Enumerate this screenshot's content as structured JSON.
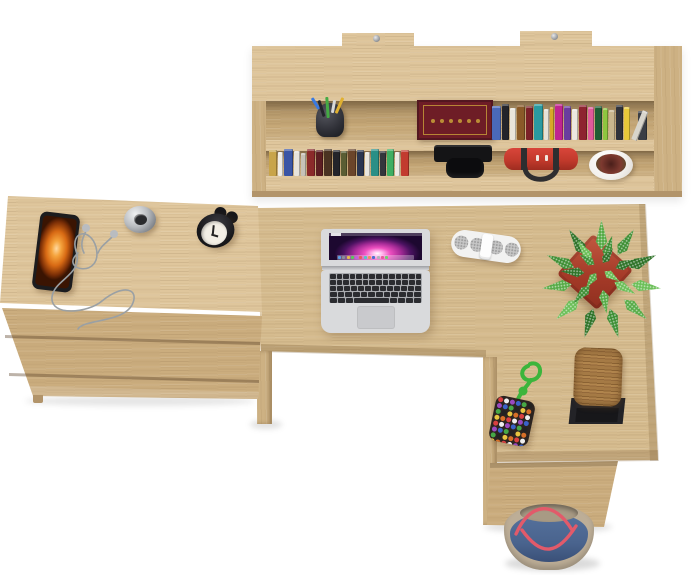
{
  "colors": {
    "wood_light": "#dfc69c",
    "wood_base": "#d6bc8f",
    "wood_mid": "#cdb183",
    "wood_front": "#cbad7e",
    "wood_edge": "#b2946a",
    "recess_back": "#c7a978",
    "laptop_silver": "#d9dadc",
    "laptop_key": "#2b2c30",
    "trackpad": "#c9cacd",
    "speaker_white": "#f2f2f1",
    "speaker_grille": "#c6c6c6",
    "pot_terracotta": "#c25a42",
    "pot_terracotta_dark": "#8e2f1f",
    "phone_frame": "#1c1c1e",
    "clock_black": "#17171a",
    "clock_face": "#f3efe6",
    "watch_silver": "#b9bcc0",
    "camera_black": "#141416",
    "bag_red": "#c23a2c",
    "bag_strap": "#2e2e30",
    "shelf_pot_white": "#f3f1ee",
    "shelf_plant_red": "#7e3a30",
    "flat_book_maroon": "#6e1d26",
    "flat_book_gold": "#c9a13a",
    "keychain_cord": "#3cb53c",
    "block_wood": "#b1854d",
    "block_stand": "#232327",
    "tote_denim": "#4a648e",
    "tote_trim": "#bdae97",
    "tote_handle": "#e25a6a",
    "cable_gray": "#9aa0a4",
    "background": "#ffffff"
  },
  "shelf": {
    "mount_tabs": 2,
    "pen_cup": {
      "cup_color": "#2e2f36",
      "pen_colors": [
        "#3a7ae0",
        "#23242a",
        "#44aa44",
        "#d8d8d8",
        "#e0b030"
      ]
    },
    "flat_book": {
      "color": "#6e1d26",
      "gold_dots": 6
    },
    "upper_books": [
      {
        "c": "#4a69b8",
        "w": 9,
        "h": 34
      },
      {
        "c": "#23242a",
        "w": 7,
        "h": 36
      },
      {
        "c": "#e9e5db",
        "w": 6,
        "h": 32
      },
      {
        "c": "#8a5a28",
        "w": 8,
        "h": 35
      },
      {
        "c": "#7c2128",
        "w": 7,
        "h": 34
      },
      {
        "c": "#2a9aa0",
        "w": 9,
        "h": 36
      },
      {
        "c": "#e6e2d8",
        "w": 5,
        "h": 31
      },
      {
        "c": "#d8a828",
        "w": 4,
        "h": 33
      },
      {
        "c": "#c02590",
        "w": 8,
        "h": 36
      },
      {
        "c": "#6a3d9e",
        "w": 7,
        "h": 34
      },
      {
        "c": "#ece8e0",
        "w": 6,
        "h": 31
      },
      {
        "c": "#8e2330",
        "w": 8,
        "h": 35
      },
      {
        "c": "#e05a9a",
        "w": 6,
        "h": 33
      },
      {
        "c": "#1f5c34",
        "w": 7,
        "h": 34
      },
      {
        "c": "#8ec63f",
        "w": 5,
        "h": 32
      },
      {
        "c": "#c9b68e",
        "w": 6,
        "h": 30
      },
      {
        "c": "#30323a",
        "w": 7,
        "h": 35
      },
      {
        "c": "#e8c83a",
        "w": 6,
        "h": 33
      },
      {
        "c": "#d8d5cc",
        "w": 6,
        "h": 31,
        "r": 22
      },
      {
        "c": "#3a3d44",
        "w": 9,
        "h": 29
      }
    ],
    "lower_books": [
      {
        "c": "#c8a44a",
        "w": 8,
        "h": 26
      },
      {
        "c": "#efece6",
        "w": 5,
        "h": 24
      },
      {
        "c": "#3a55a5",
        "w": 9,
        "h": 27
      },
      {
        "c": "#e8e4dc",
        "w": 6,
        "h": 25
      },
      {
        "c": "#c7c2b8",
        "w": 5,
        "h": 23
      },
      {
        "c": "#8b2a2a",
        "w": 8,
        "h": 27
      },
      {
        "c": "#5c1e22",
        "w": 7,
        "h": 26
      },
      {
        "c": "#4a3322",
        "w": 8,
        "h": 27
      },
      {
        "c": "#23242a",
        "w": 7,
        "h": 26
      },
      {
        "c": "#5a5d33",
        "w": 6,
        "h": 25
      },
      {
        "c": "#6b452a",
        "w": 8,
        "h": 27
      },
      {
        "c": "#2a3550",
        "w": 7,
        "h": 26
      },
      {
        "c": "#e9e6df",
        "w": 5,
        "h": 24
      },
      {
        "c": "#2a8f86",
        "w": 8,
        "h": 27
      },
      {
        "c": "#34363c",
        "w": 6,
        "h": 25
      },
      {
        "c": "#3fae62",
        "w": 7,
        "h": 27
      },
      {
        "c": "#eceae3",
        "w": 5,
        "h": 24
      },
      {
        "c": "#c23b2f",
        "w": 8,
        "h": 26
      }
    ]
  },
  "cabinet": {
    "drawer_count": 3
  },
  "desk": {
    "laptop": {
      "dock_colors": [
        "#5aa0e8",
        "#8a8f98",
        "#e8b84a",
        "#5ac85a",
        "#c85ae0",
        "#e85a5a",
        "#50c8c8",
        "#e8985a",
        "#4a6fd0",
        "#b0b4bc",
        "#e85a9a",
        "#70d070"
      ],
      "keyboard_rows": [
        14,
        14,
        13,
        12
      ],
      "bottom_row": {
        "keys_left": 3,
        "space_flex": 5,
        "keys_right": 4
      }
    },
    "speaker": {
      "grilles": 4
    },
    "plant": {
      "leaf_colors": [
        "#57ab47",
        "#3f8f35",
        "#2f7329",
        "#6bbf58"
      ],
      "rings": [
        {
          "count": 11,
          "radius": 30,
          "len": 30,
          "wid": 15
        },
        {
          "count": 7,
          "radius": 16,
          "len": 24,
          "wid": 13
        },
        {
          "count": 4,
          "radius": 6,
          "len": 18,
          "wid": 11
        }
      ]
    }
  },
  "return_desk": {
    "keychain": {
      "bead_colors": [
        "#d94040",
        "#3a62c8",
        "#e8c440",
        "#eeeeee",
        "#46a846",
        "#d87028",
        "#9a4ac0",
        "#222222"
      ],
      "bead_grid": {
        "cols": 6,
        "rows": 8
      }
    }
  }
}
